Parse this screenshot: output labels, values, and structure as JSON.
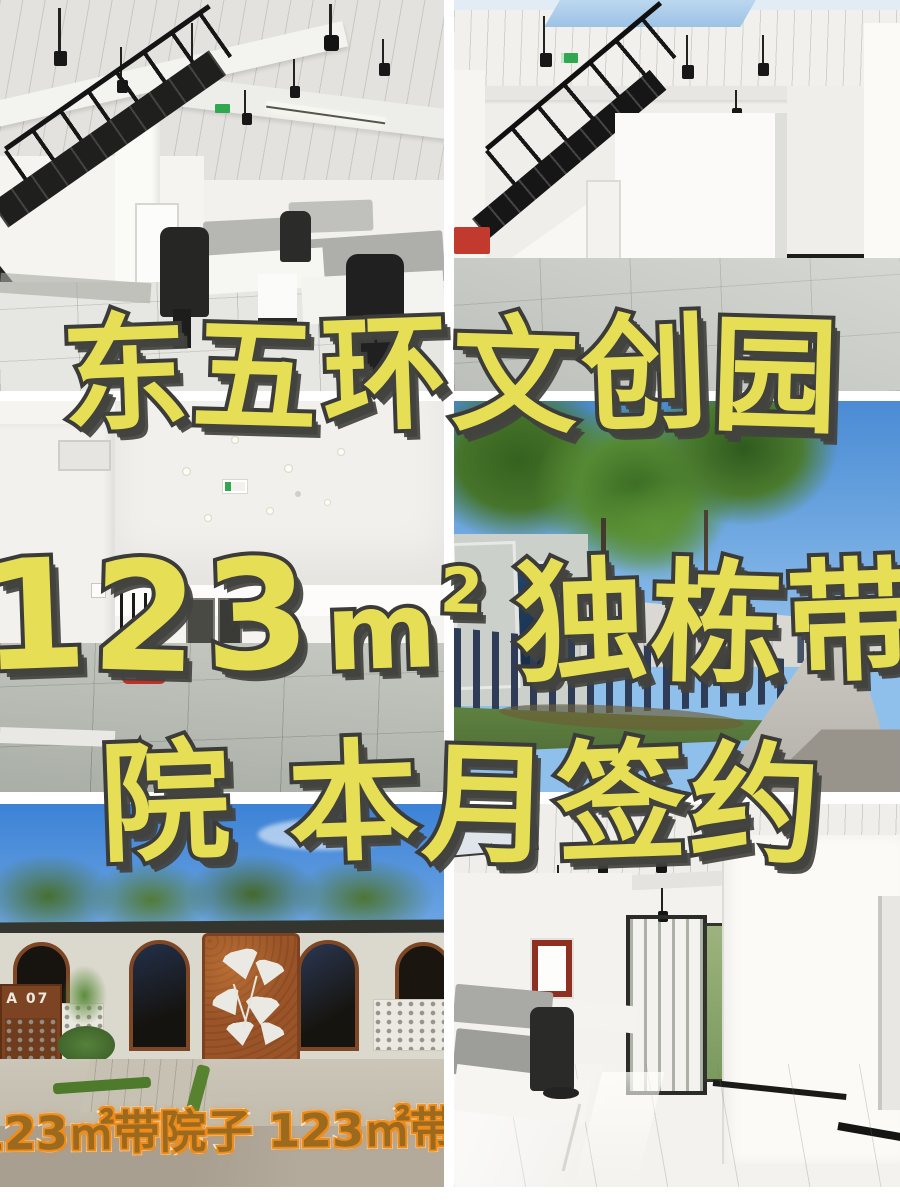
{
  "meta": {
    "canvas_width": 900,
    "canvas_height": 1200
  },
  "colors": {
    "background": "#ffffff",
    "headline_fill": "#e6df55",
    "headline_outline": "#3b3b39",
    "headline_shadow": "rgba(66,66,63,0.92)",
    "watermark_fill": "#9c6a1e",
    "watermark_outline": "#f8f1da",
    "watermark_glow": "#ef8c1a",
    "exit_sign_green": "#2fa850",
    "sky_blue": "#4a8bd4",
    "corten_rust": "#9a5428"
  },
  "headline": {
    "line1": "东五环文创园",
    "line2": {
      "number": "123",
      "unit": "m",
      "sup": "2",
      "words": "独栋带"
    },
    "line3": "院 本月签约"
  },
  "signs": {
    "unit_plate": "A 07",
    "watermark": "123㎡带院子 123㎡带院子"
  }
}
